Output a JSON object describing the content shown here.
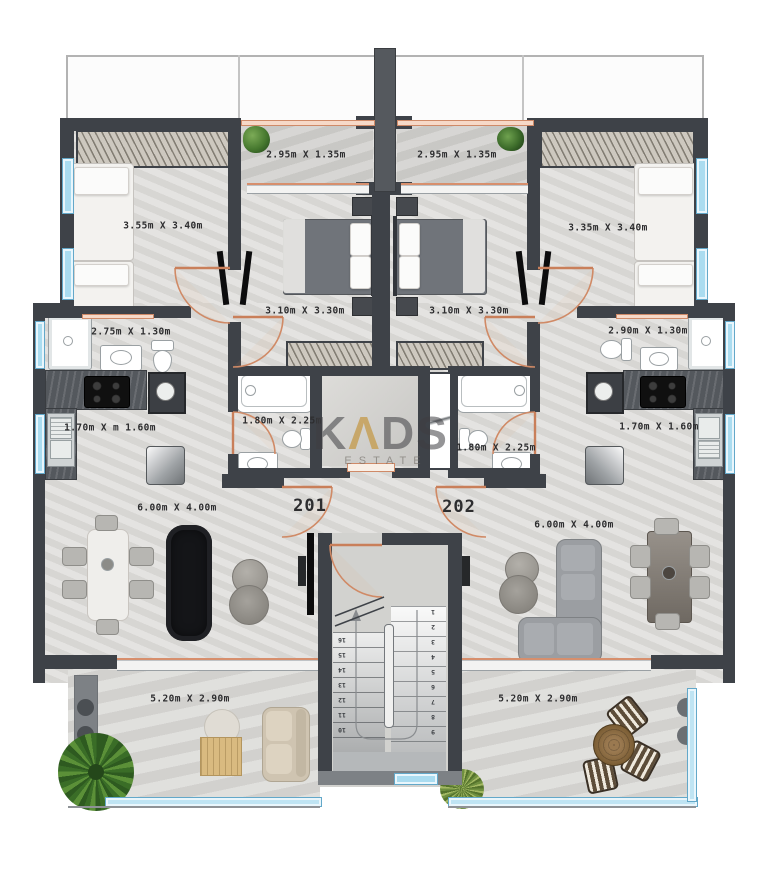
{
  "watermark": {
    "k": "K",
    "a": "Λ",
    "ds": "DS",
    "sub": "ESTATE"
  },
  "units": {
    "left": "201",
    "right": "202"
  },
  "labels": {
    "balcony_top_left": "2.95m X 1.35m",
    "balcony_top_right": "2.95m X 1.35m",
    "bedroom_left": "3.55m X 3.40m",
    "bedroom_right": "3.35m X 3.40m",
    "bedroom_mid_left": "3.10m X 3.30m",
    "bedroom_mid_right": "3.10m X 3.30m",
    "bath_left": "2.75m X 1.30m",
    "bath_right": "2.90m X 1.30m",
    "bath_inner_left": "1.80m X 2.25m",
    "bath_inner_right": "1.80m X 2.25m",
    "kitchen_left": "1.70m X m 1.60m",
    "kitchen_right": "1.70m X 1.60m",
    "living_left": "6.00m X 4.00m",
    "living_right": "6.00m X 4.00m",
    "balcony_bottom_left": "5.20m X 2.90m",
    "balcony_bottom_right": "5.20m X 2.90m"
  },
  "stairs": {
    "right": [
      "1",
      "2",
      "3",
      "4",
      "5",
      "6",
      "7",
      "8",
      "9"
    ],
    "left": [
      "16",
      "15",
      "14",
      "13",
      "12",
      "11",
      "10"
    ]
  },
  "colors": {
    "wall": "#3e4248",
    "window": "#aadcf0",
    "door": "#d08a66",
    "gold": "#c6a058"
  }
}
